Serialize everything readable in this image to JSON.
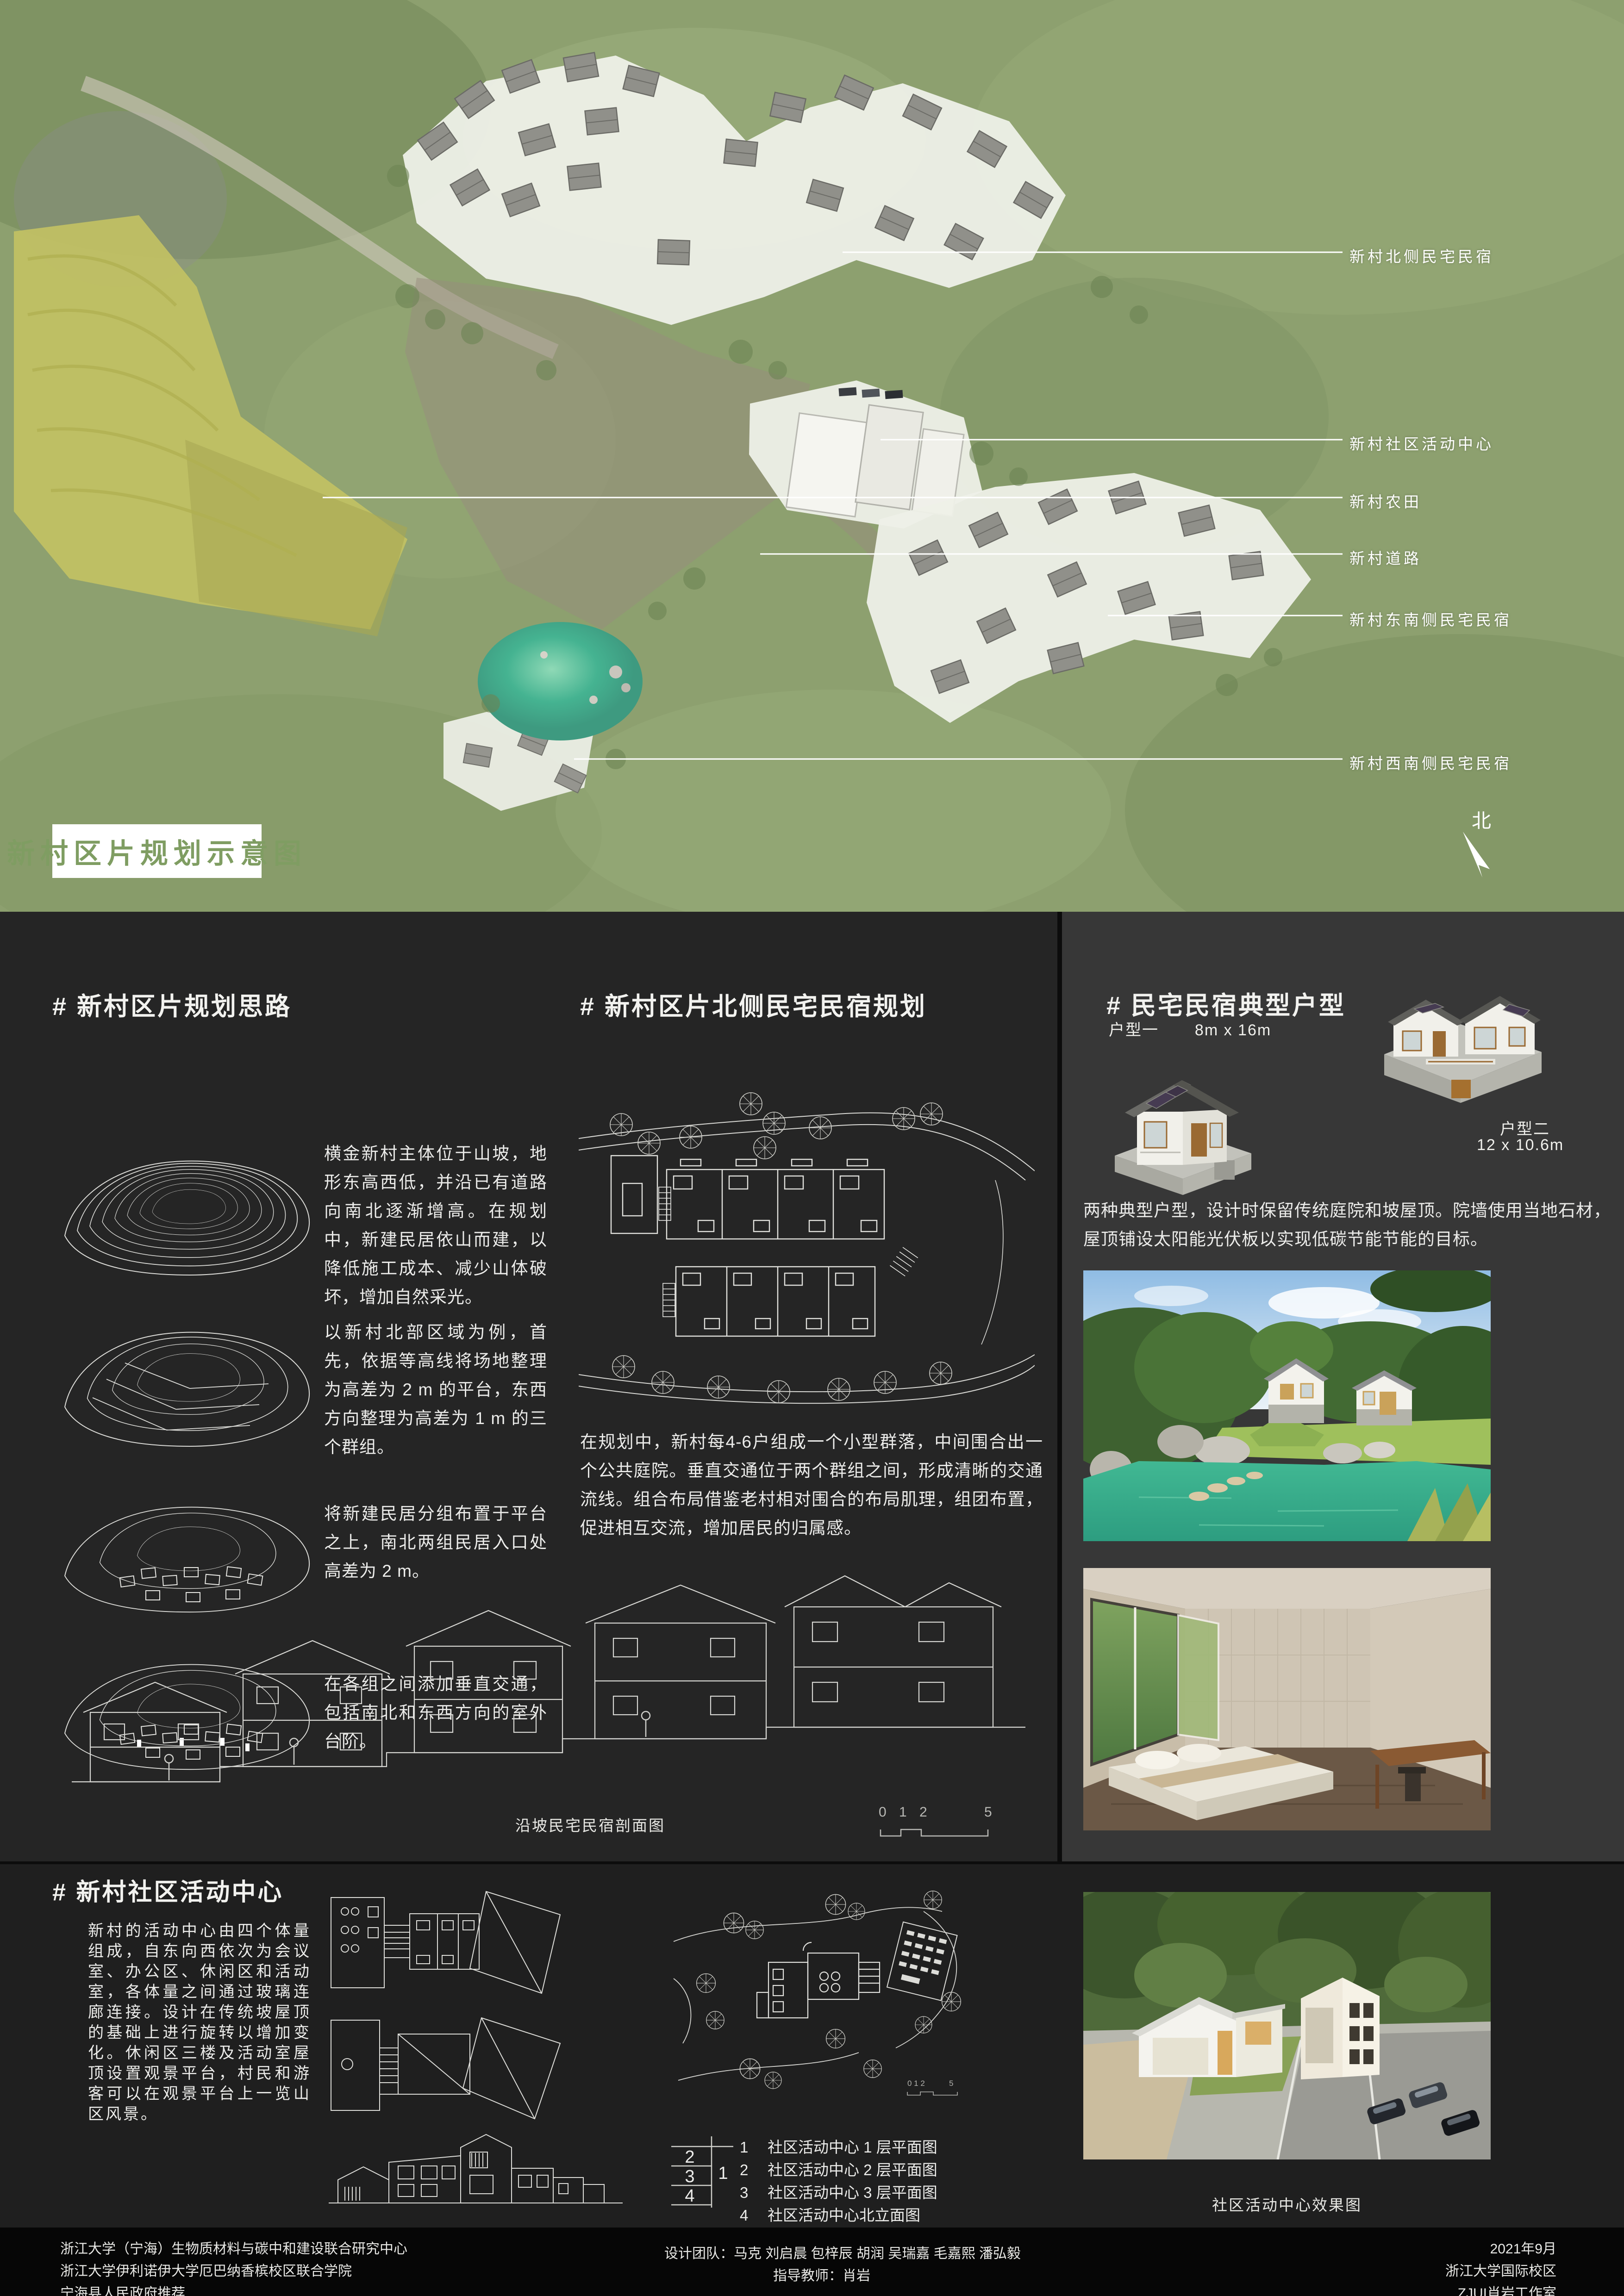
{
  "map": {
    "title": "新村区片规划示意图",
    "north_label": "北",
    "labels": [
      "新村北侧民宅民宿",
      "新村社区活动中心",
      "新村农田",
      "新村道路",
      "新村东南侧民宅民宿",
      "新村西南侧民宅民宿"
    ]
  },
  "sections": {
    "planning": {
      "heading": "# 新村区片规划思路",
      "paragraphs": [
        "横金新村主体位于山坡，地形东高西低，并沿已有道路向南北逐渐增高。在规划中，新建民居依山而建，以降低施工成本、减少山体破坏，增加自然采光。",
        "以新村北部区域为例，首先，依据等高线将场地整理为高差为 2 m 的平台，东西方向整理为高差为 1 m 的三个群组。",
        "将新建民居分组布置于平台之上，南北两组民居入口处高差为 2 m。",
        "在各组之间添加垂直交通，包括南北和东西方向的室外台阶。"
      ]
    },
    "north_housing": {
      "heading": "# 新村区片北侧民宅民宿规划",
      "paragraph": "在规划中，新村每4-6户组成一个小型群落，中间围合出一个公共庭院。垂直交通位于两个群组之间，形成清晰的交通流线。组合布局借鉴老村相对围合的布局肌理，组团布置，促进相互交流，增加居民的归属感。",
      "section_caption": "沿坡民宅民宿剖面图",
      "scale_ticks": [
        "0",
        "1",
        "2",
        "5"
      ]
    },
    "typology": {
      "heading": "# 民宅民宿典型户型",
      "type1_label": "户型一",
      "type1_size": "8m x 16m",
      "type2_label": "户型二",
      "type2_size": "12 x 10.6m",
      "paragraph": "两种典型户型，设计时保留传统庭院和坡屋顶。院墙使用当地石材，屋顶铺设太阳能光伏板以实现低碳节能节能的目标。"
    },
    "community": {
      "heading": "# 新村社区活动中心",
      "paragraph": "新村的活动中心由四个体量组成，自东向西依次为会议室、办公区、休闲区和活动室，各体量之间通过玻璃连廊连接。设计在传统坡屋顶的基础上进行旋转以增加变化。休闲区三楼及活动室屋顶设置观景平台，村民和游客可以在观景平台上一览山区风景。",
      "key_numbers": [
        "2",
        "3",
        "4",
        "1"
      ],
      "legend": [
        {
          "num": "1",
          "label": "社区活动中心 1 层平面图"
        },
        {
          "num": "2",
          "label": "社区活动中心 2 层平面图"
        },
        {
          "num": "3",
          "label": "社区活动中心 3 层平面图"
        },
        {
          "num": "4",
          "label": "社区活动中心北立面图"
        }
      ],
      "render_caption": "社区活动中心效果图"
    }
  },
  "footer": {
    "left_lines": [
      "浙江大学（宁海）生物质材料与碳中和建设联合研究中心",
      "浙江大学伊利诺伊大学厄巴纳香槟校区联合学院",
      "宁海县人民政府推荐"
    ],
    "team": "设计团队：马克 刘启晨 包梓辰 胡润 吴瑞嘉 毛嘉熙 潘弘毅",
    "advisor": "指导教师：肖岩",
    "right_lines": [
      "2021年9月",
      "浙江大学国际校区",
      "ZJUI肖岩工作室"
    ]
  },
  "colors": {
    "accent_green": "#7f9d62",
    "panel_dark": "#252525",
    "panel_mid": "#373737",
    "panel_bottom": "#1f1f1f",
    "footer_black": "#060606",
    "pond_teal": "#45b391",
    "field_yellow": "#c2c163"
  }
}
